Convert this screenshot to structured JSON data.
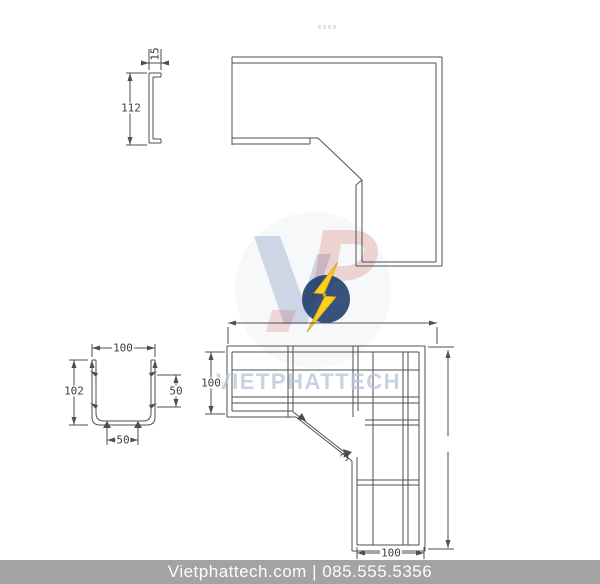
{
  "watermark": {
    "text": "VIETPHATTECH"
  },
  "footer": {
    "text": "Vietphattech.com | 085.555.5356"
  },
  "dimensions": {
    "side_profile_height": "112",
    "side_profile_flange": "15",
    "section_width": "100",
    "section_height": "102",
    "section_side_pitch": "50",
    "section_bottom_pitch": "50",
    "tray_arm_width": "100",
    "tray_bottom_width": "100",
    "tray_thickness": "3"
  },
  "colors": {
    "line": "#4f4f4f",
    "dim_text": "#3d3d3d",
    "watermark": "#b6c3d7",
    "footer_bar": "#a3a3a3",
    "logo_navy": "#1b3a6b",
    "logo_bolt": "#f8d21a",
    "logo_red": "#c23b2a",
    "logo_blue": "#2b4d8f"
  }
}
